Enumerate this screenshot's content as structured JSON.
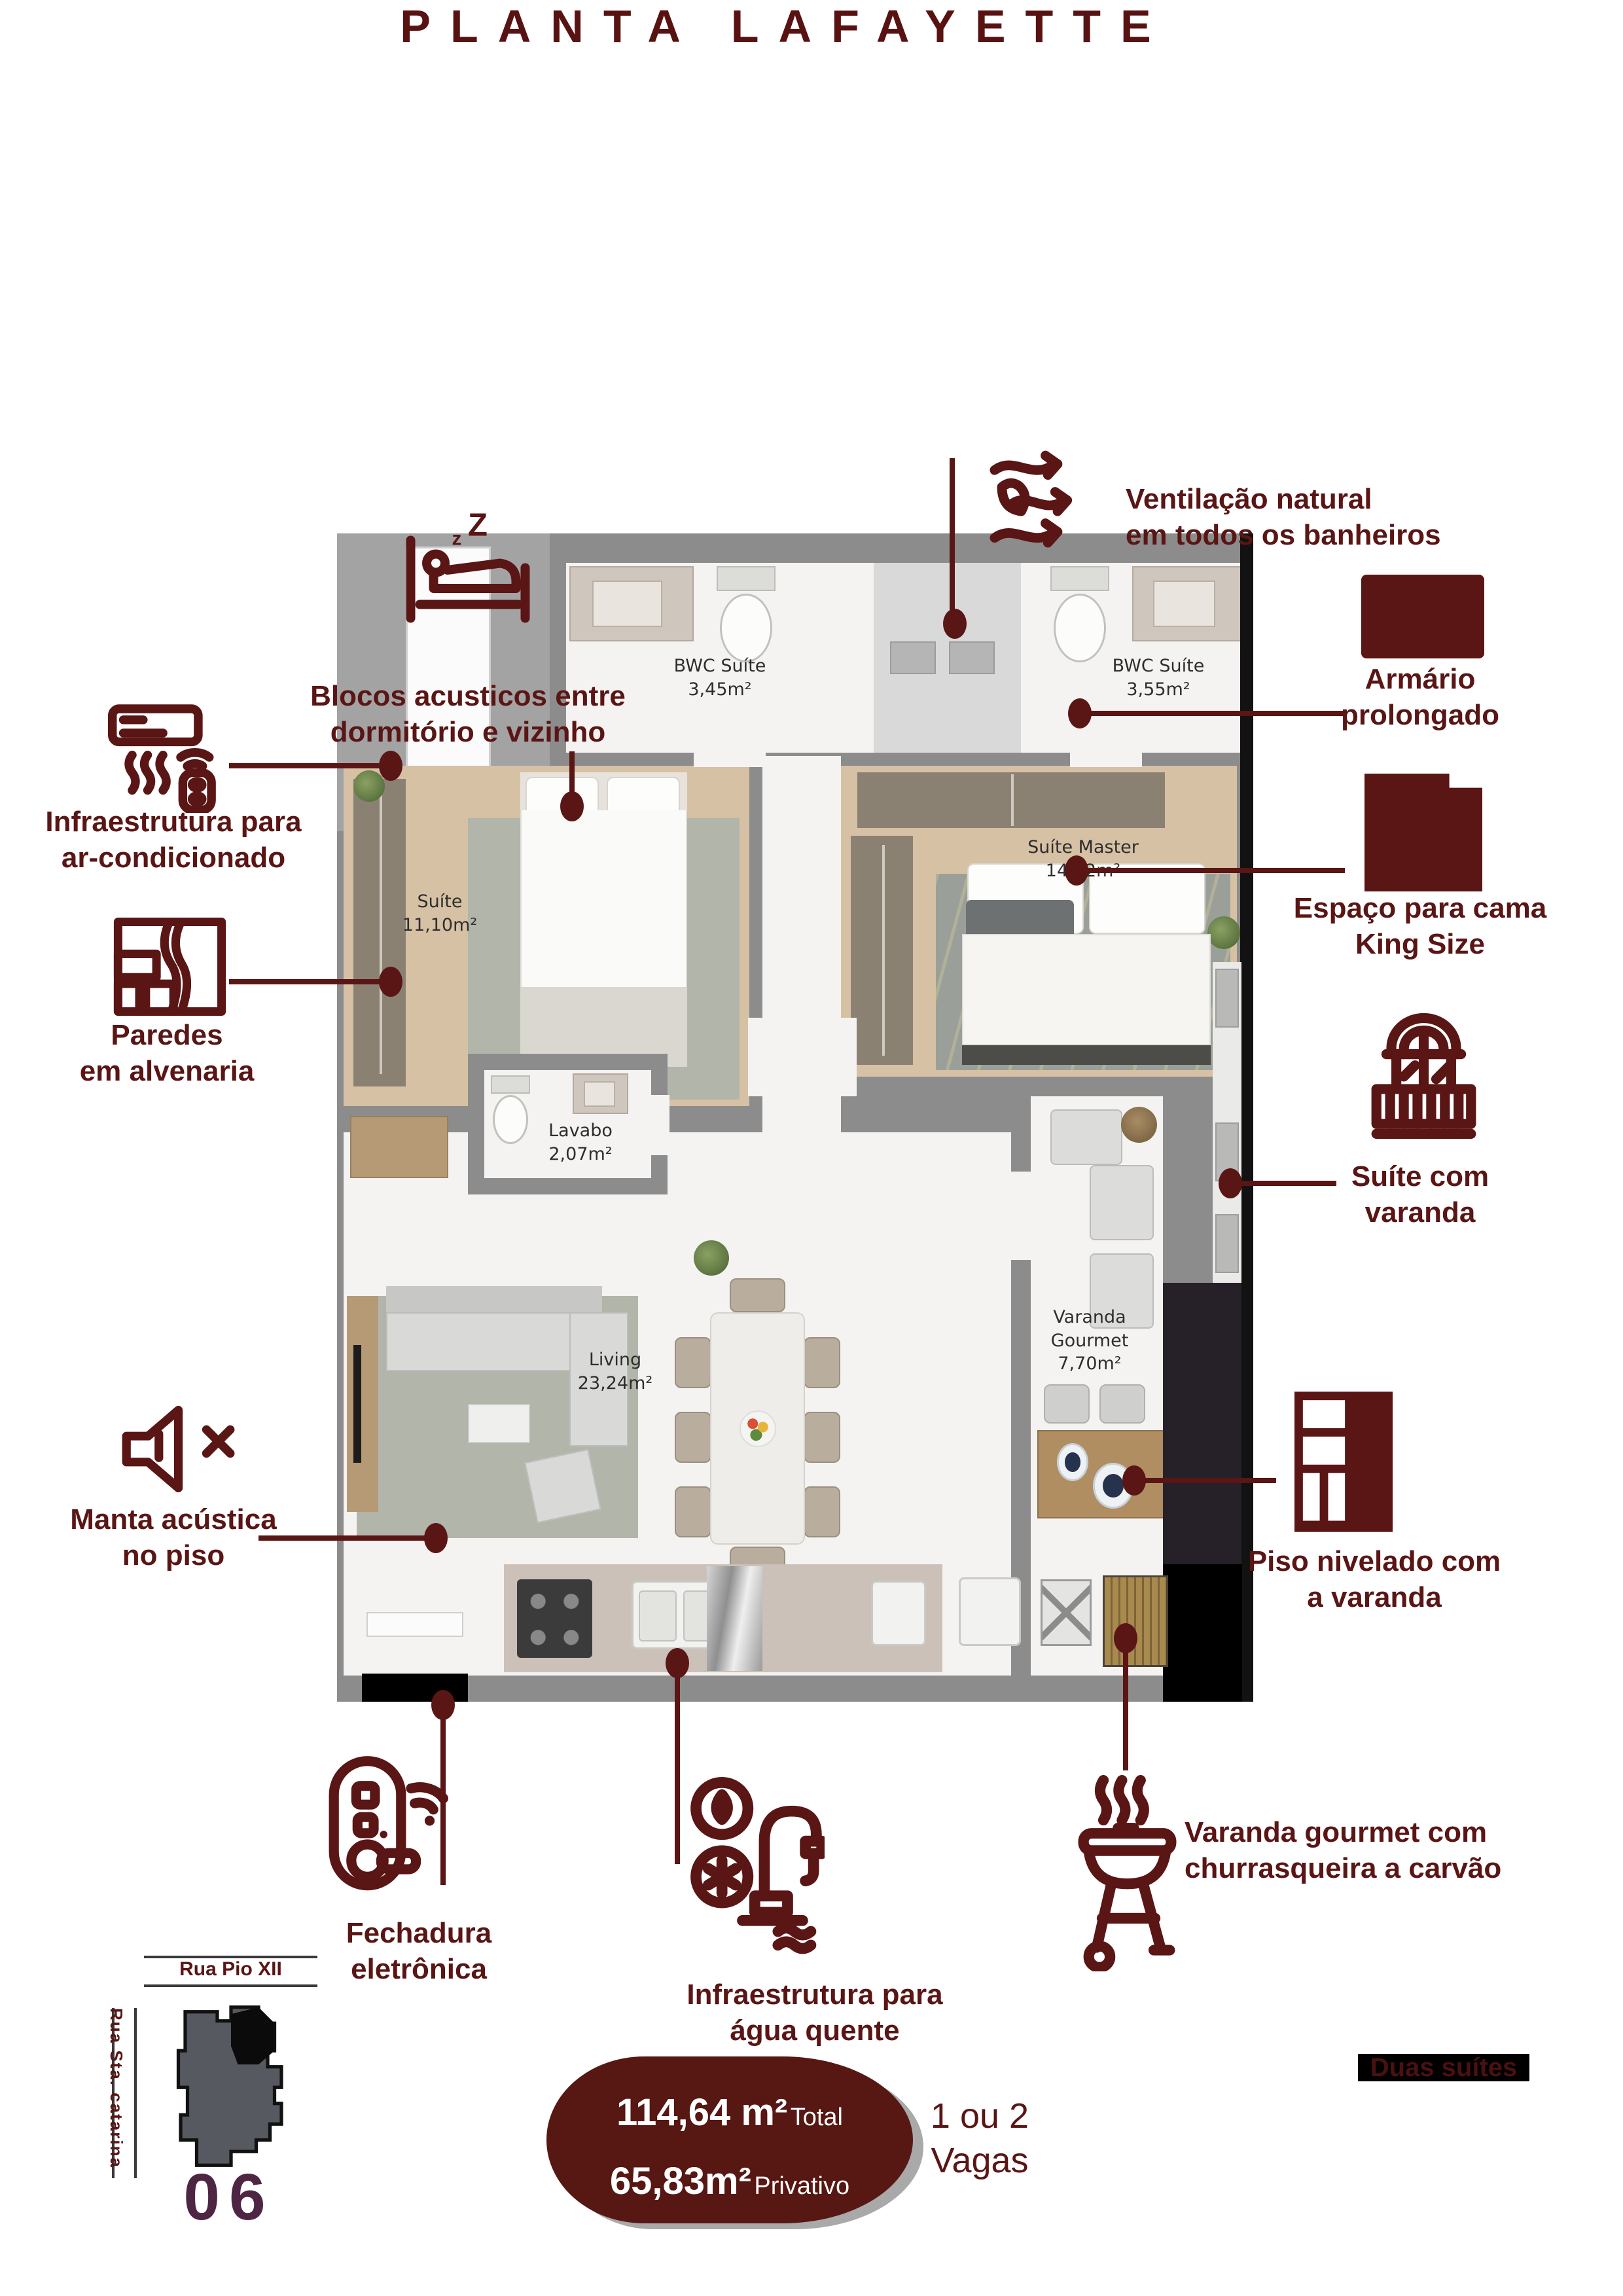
{
  "theme": {
    "maroon": "#5A1515",
    "plum": "#4E2644",
    "badge_bg": "#571712"
  },
  "title": "PLANTA LAFAYETTE",
  "rooms": {
    "bwc1": {
      "name": "BWC Suíte",
      "area": "3,45m²"
    },
    "bwc2": {
      "name": "BWC Suíte",
      "area": "3,55m²"
    },
    "suite": {
      "name": "Suíte",
      "area": "11,10m²"
    },
    "master": {
      "name": "Suíte Master",
      "area": "14,72m²"
    },
    "lavabo": {
      "name": "Lavabo",
      "area": "2,07m²"
    },
    "living": {
      "name": "Living",
      "area": "23,24m²"
    },
    "varanda": {
      "name_line1": "Varanda",
      "name_line2": "Gourmet",
      "area": "7,70m²"
    }
  },
  "callouts": {
    "ventilacao": {
      "line1": "Ventilação natural",
      "line2": "em todos os banheiros",
      "icon": "wind-leaf-icon"
    },
    "blocos": {
      "line1": "Blocos acusticos entre",
      "line2": "dormitório e vizinho",
      "icon": "sleeping-bed-icon"
    },
    "infra_ar": {
      "line1": "Infraestrutura para",
      "line2": "ar-condicionado",
      "icon": "air-conditioner-icon"
    },
    "paredes": {
      "line1": "Paredes",
      "line2": "em alvenaria",
      "icon": "brick-wall-icon"
    },
    "armario": {
      "line1": "Armário",
      "line2": "prolongado",
      "icon": "wardrobe-icon"
    },
    "king": {
      "line1": "Espaço para cama",
      "line2": "King Size",
      "icon": "king-bed-icon"
    },
    "suite_varanda": {
      "line1": "Suíte com",
      "line2": "varanda",
      "icon": "balcony-icon"
    },
    "piso": {
      "line1": "Piso nivelado com",
      "line2": "a varanda",
      "icon": "level-floor-icon"
    },
    "manta": {
      "line1": "Manta acústica",
      "line2": "no piso",
      "icon": "muted-speaker-icon"
    },
    "fechadura": {
      "line1": "Fechadura",
      "line2": "eletrônica",
      "icon": "smart-lock-icon"
    },
    "agua": {
      "line1": "Infraestrutura para",
      "line2": "água quente",
      "icon": "hot-water-icon"
    },
    "churrasqueira": {
      "line1": "Varanda gourmet com",
      "line2": "churrasqueira a carvão",
      "icon": "charcoal-grill-icon"
    }
  },
  "map": {
    "street_top": "Rua Pio XII",
    "street_side": "Rua Sta. catarina",
    "unit_number": "06"
  },
  "summary": {
    "total_value": "114,64 m²",
    "total_label": "Total",
    "private_value": "65,83m²",
    "private_label": "Privativo",
    "parking_line1": "1 ou 2",
    "parking_line2": "Vagas",
    "suites": "Duas suítes"
  }
}
